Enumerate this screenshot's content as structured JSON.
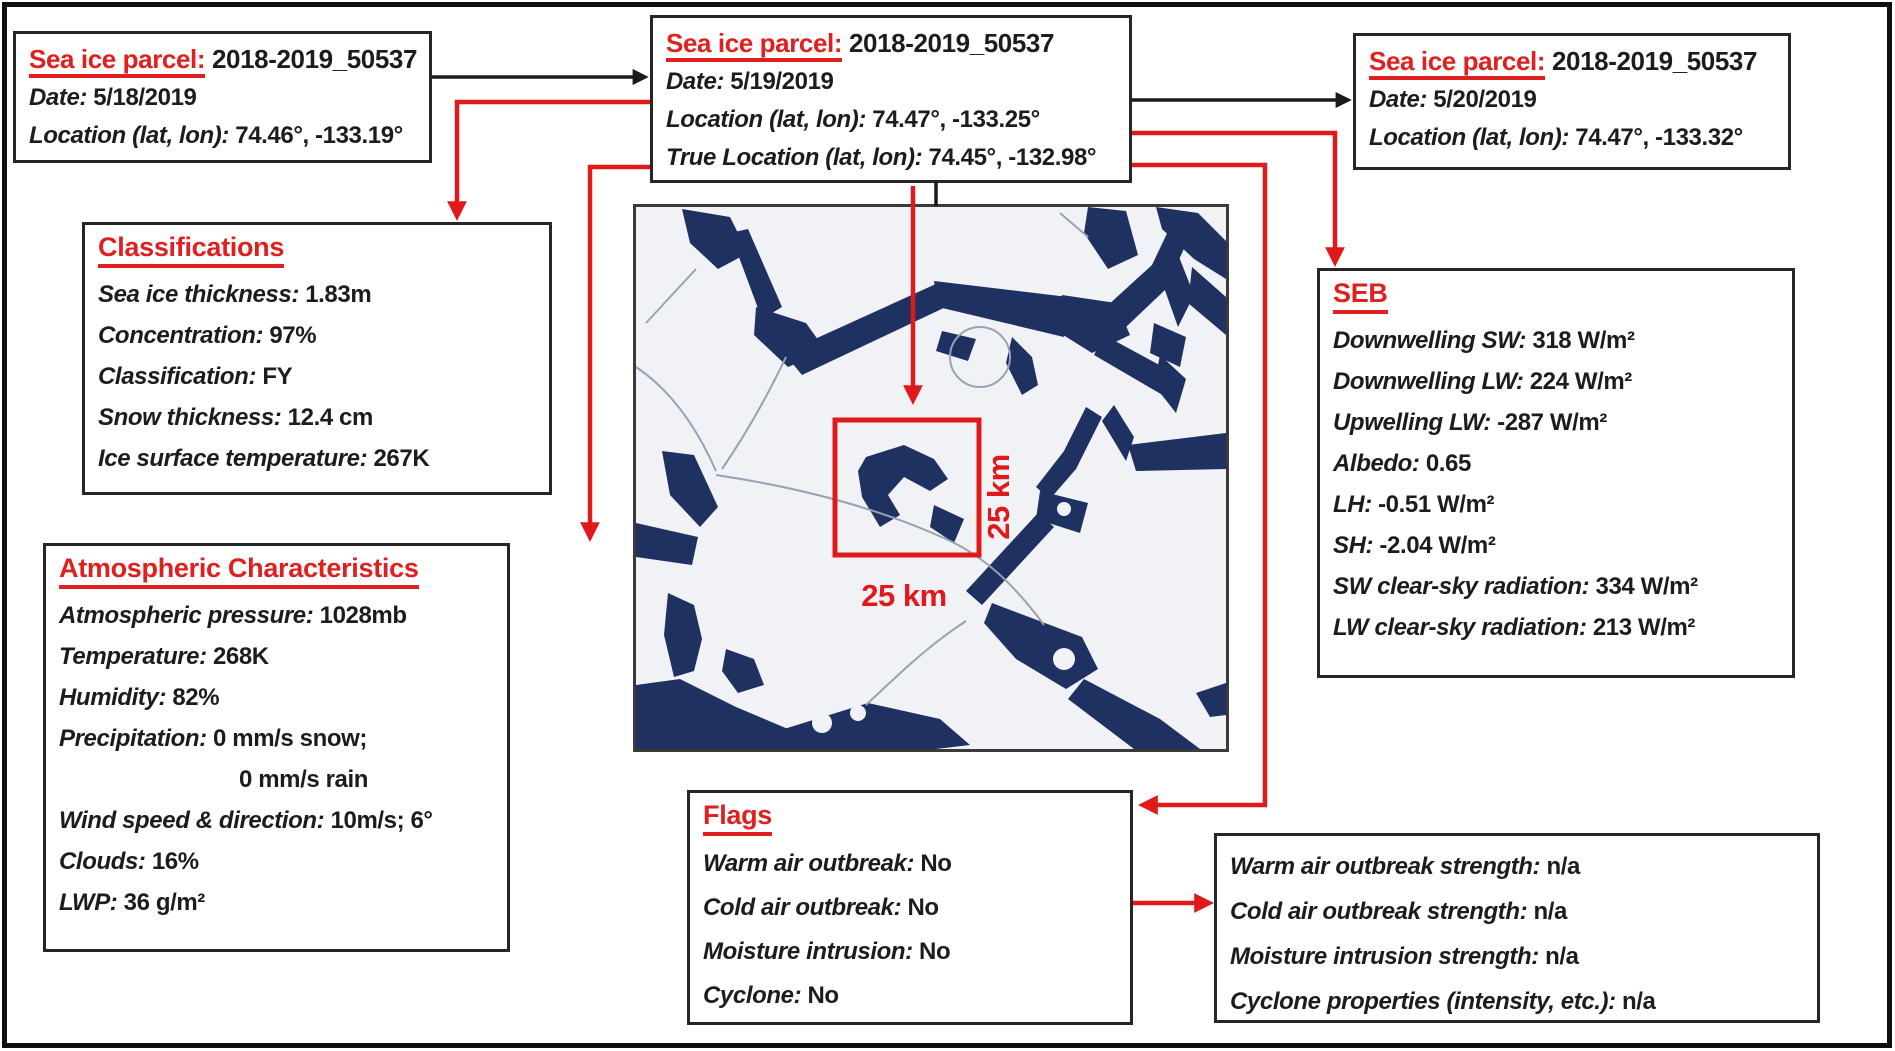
{
  "colors": {
    "accent_red": "#e01f1f",
    "arrow_red": "#e01a1a",
    "arrow_black": "#1a1a1a",
    "sea_water_navy": "#1e3160",
    "ice_background": "#f0f2f6"
  },
  "parcels": {
    "prev": {
      "title_label": "Sea ice parcel:",
      "title_value": "2018-2019_50537",
      "rows": [
        {
          "label": "Date:",
          "value": "5/18/2019"
        },
        {
          "label": "Location (lat, lon):",
          "value": "74.46°, -133.19°"
        }
      ]
    },
    "main": {
      "title_label": "Sea ice parcel:",
      "title_value": "2018-2019_50537",
      "rows": [
        {
          "label": "Date:",
          "value": "5/19/2019"
        },
        {
          "label": "Location (lat, lon):",
          "value": "74.47°, -133.25°"
        },
        {
          "label": "True Location (lat, lon):",
          "value": "74.45°, -132.98°"
        }
      ]
    },
    "next": {
      "title_label": "Sea ice parcel:",
      "title_value": "2018-2019_50537",
      "rows": [
        {
          "label": "Date:",
          "value": "5/20/2019"
        },
        {
          "label": "Location (lat, lon):",
          "value": "74.47°, -133.32°"
        }
      ]
    }
  },
  "classifications": {
    "header": "Classifications",
    "rows": [
      {
        "label": "Sea ice thickness:",
        "value": "1.83m"
      },
      {
        "label": "Concentration:",
        "value": "97%"
      },
      {
        "label": "Classification:",
        "value": "FY"
      },
      {
        "label": "Snow thickness:",
        "value": "12.4 cm"
      },
      {
        "label": "Ice surface temperature:",
        "value": "267K"
      }
    ]
  },
  "atmospheric": {
    "header": "Atmospheric Characteristics",
    "rows": [
      {
        "label": "Atmospheric pressure:",
        "value": "1028mb"
      },
      {
        "label": "Temperature:",
        "value": "268K"
      },
      {
        "label": "Humidity:",
        "value": "82%"
      },
      {
        "label": "Precipitation:",
        "value": "0 mm/s snow;"
      },
      {
        "label": "",
        "value": "0 mm/s rain"
      },
      {
        "label": "Wind speed & direction:",
        "value": "10m/s; 6°"
      },
      {
        "label": "Clouds:",
        "value": "16%"
      },
      {
        "label": "LWP:",
        "value": "36 g/m²"
      }
    ]
  },
  "seb": {
    "header": "SEB",
    "rows": [
      {
        "label": "Downwelling SW:",
        "value": "318 W/m²"
      },
      {
        "label": "Downwelling LW:",
        "value": "224 W/m²"
      },
      {
        "label": "Upwelling LW:",
        "value": "-287 W/m²"
      },
      {
        "label": "Albedo:",
        "value": "0.65"
      },
      {
        "label": "LH:",
        "value": "-0.51 W/m²"
      },
      {
        "label": "SH:",
        "value": "-2.04 W/m²"
      },
      {
        "label": "SW clear-sky radiation:",
        "value": "334 W/m²"
      },
      {
        "label": "LW clear-sky radiation:",
        "value": "213 W/m²"
      }
    ]
  },
  "flags": {
    "header": "Flags",
    "rows": [
      {
        "label": "Warm air outbreak:",
        "value": "No"
      },
      {
        "label": "Cold air outbreak:",
        "value": "No"
      },
      {
        "label": "Moisture intrusion:",
        "value": "No"
      },
      {
        "label": "Cyclone:",
        "value": "No"
      }
    ]
  },
  "strengths": {
    "rows": [
      {
        "label": "Warm air outbreak strength:",
        "value": "n/a"
      },
      {
        "label": "Cold air outbreak strength:",
        "value": "n/a"
      },
      {
        "label": "Moisture intrusion strength:",
        "value": "n/a"
      },
      {
        "label": "Cyclone properties (intensity, etc.):",
        "value": "n/a"
      }
    ]
  },
  "map": {
    "scale_bottom": "25 km",
    "scale_side": "25 km"
  }
}
